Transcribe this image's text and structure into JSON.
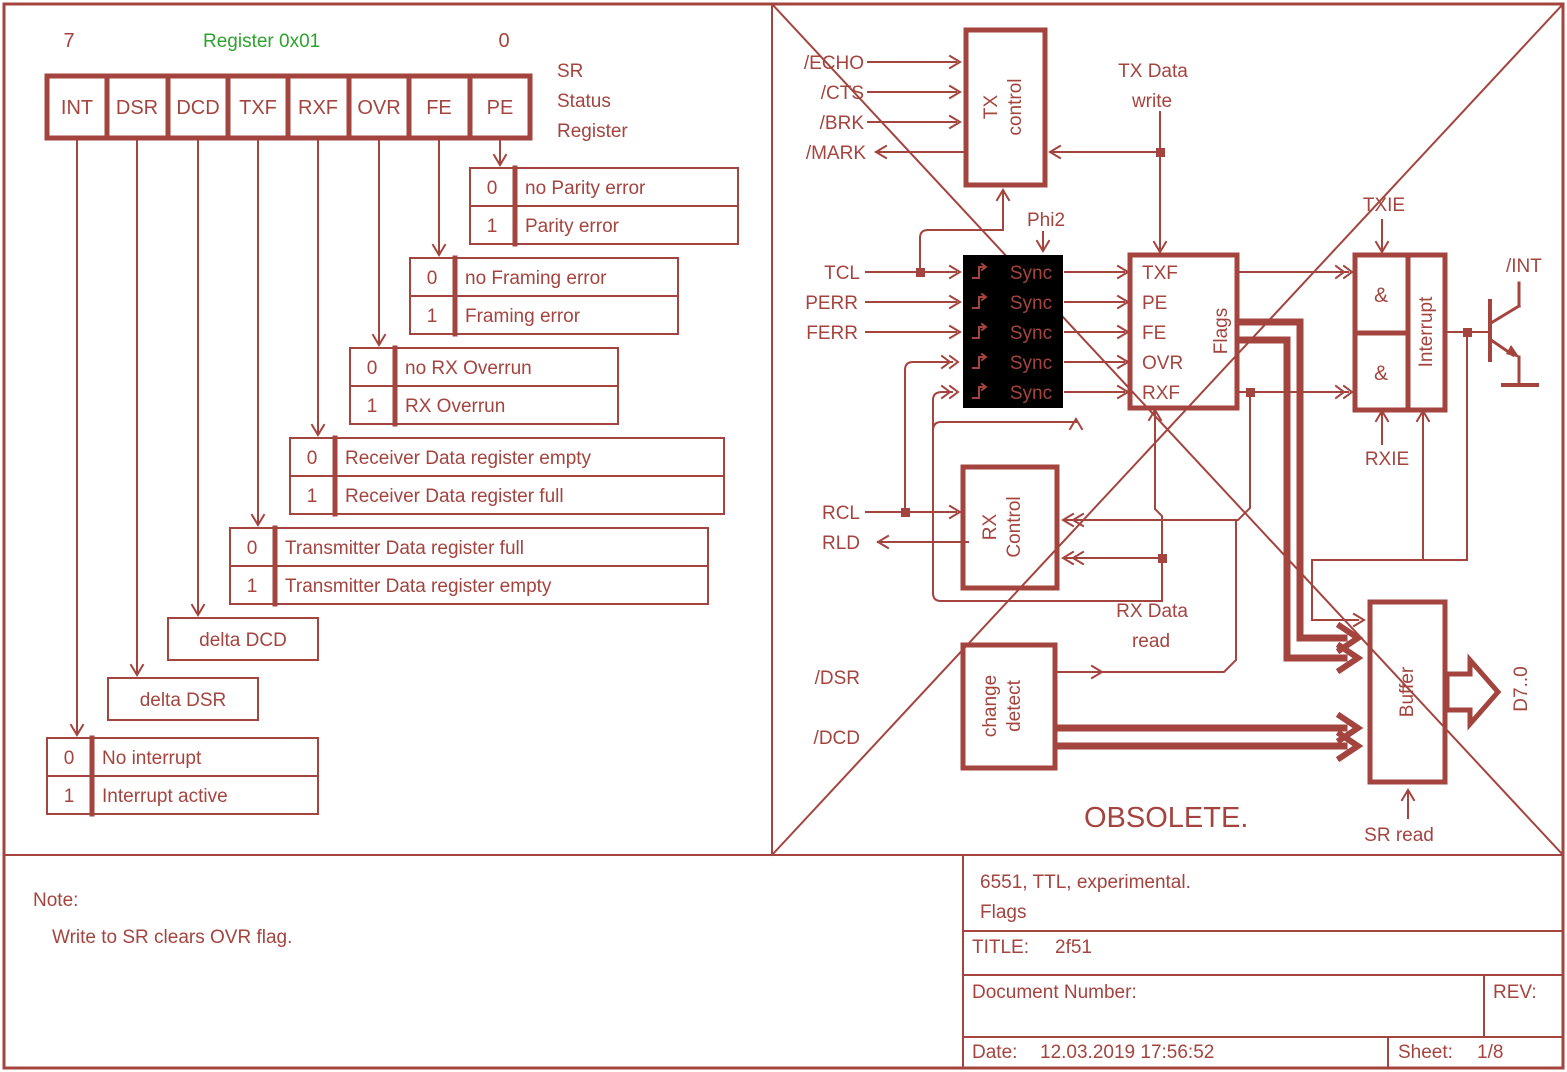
{
  "colors": {
    "ink": "#A4443F",
    "green": "#2DA32D",
    "background": "#FFFFFF"
  },
  "left": {
    "bit_index_high": "7",
    "bit_index_low": "0",
    "register_title": "Register 0x01",
    "register_name": [
      "SR",
      "Status",
      "Register"
    ],
    "bits": [
      "INT",
      "DSR",
      "DCD",
      "TXF",
      "RXF",
      "OVR",
      "FE",
      "PE"
    ],
    "tables": [
      {
        "name": "PE",
        "rows": [
          [
            "0",
            "no Parity error"
          ],
          [
            "1",
            "Parity error"
          ]
        ]
      },
      {
        "name": "FE",
        "rows": [
          [
            "0",
            "no Framing error"
          ],
          [
            "1",
            "Framing error"
          ]
        ]
      },
      {
        "name": "OVR",
        "rows": [
          [
            "0",
            "no RX Overrun"
          ],
          [
            "1",
            "RX Overrun"
          ]
        ]
      },
      {
        "name": "RXF",
        "rows": [
          [
            "0",
            "Receiver Data register empty"
          ],
          [
            "1",
            "Receiver Data register full"
          ]
        ]
      },
      {
        "name": "TXF",
        "rows": [
          [
            "0",
            "Transmitter Data register full"
          ],
          [
            "1",
            "Transmitter Data register empty"
          ]
        ]
      },
      {
        "name": "INT",
        "rows": [
          [
            "0",
            "No interrupt"
          ],
          [
            "1",
            "Interrupt active"
          ]
        ]
      }
    ],
    "delta_boxes": [
      "delta DCD",
      "delta DSR"
    ]
  },
  "diagram": {
    "blocks": {
      "tx_control": [
        "TX",
        "control"
      ],
      "sync": "Sync",
      "flags": {
        "title": "Flags",
        "rows": [
          "TXF",
          "PE",
          "FE",
          "OVR",
          "RXF"
        ]
      },
      "interrupt": {
        "title": "Interrupt",
        "gate": "&"
      },
      "rx_control": [
        "RX",
        "Control"
      ],
      "change_detect": [
        "change",
        "detect"
      ],
      "buffer": "Buffer"
    },
    "signals": {
      "echo": "/ECHO",
      "cts": "/CTS",
      "brk": "/BRK",
      "mark": "/MARK",
      "tx_data": [
        "TX Data",
        "write"
      ],
      "phi2": "Phi2",
      "tcl": "TCL",
      "perr": "PERR",
      "ferr": "FERR",
      "txie": "TXIE",
      "int": "/INT",
      "rxie": "RXIE",
      "rcl": "RCL",
      "rld": "RLD",
      "rx_data": [
        "RX Data",
        "read"
      ],
      "dsr": "/DSR",
      "dcd": "/DCD",
      "d_bus": "D7..0",
      "sr_read": "SR read"
    },
    "watermark": "OBSOLETE."
  },
  "note": {
    "title": "Note:",
    "body": "Write to SR clears OVR flag."
  },
  "title_block": {
    "description_line1": "6551, TTL, experimental.",
    "description_line2": "Flags",
    "title_label": "TITLE:",
    "title_value": "2f51",
    "document_label": "Document Number:",
    "rev_label": "REV:",
    "date_label": "Date:",
    "date_value": "12.03.2019 17:56:52",
    "sheet_label": "Sheet:",
    "sheet_value": "1/8"
  }
}
